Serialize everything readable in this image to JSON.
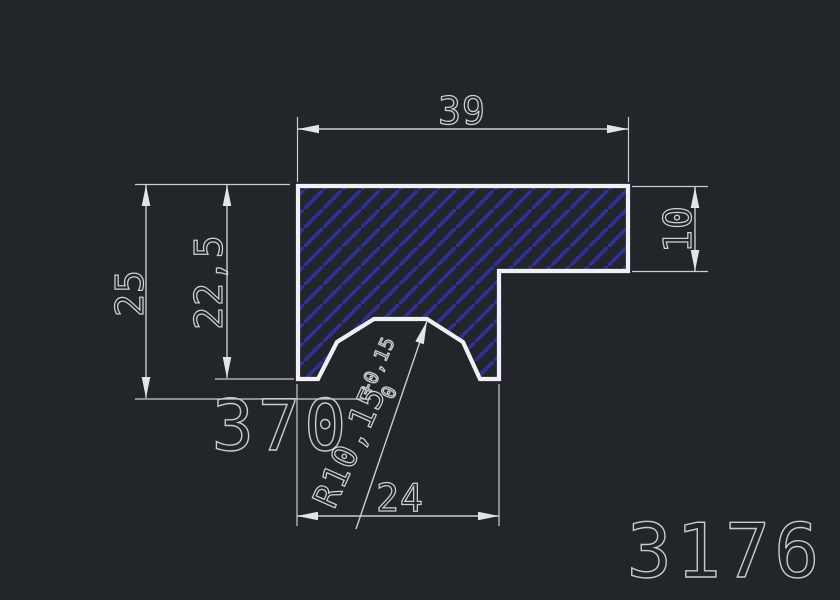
{
  "drawing": {
    "dims": {
      "top_width": "39",
      "overall_height": "25",
      "profile_height": "22,5",
      "step_height": "10",
      "groove_width": "24",
      "radius": "R10,15",
      "radius_tol_upper": "+0,15",
      "radius_tol_lower": "0"
    },
    "labels": {
      "watermark": "370",
      "part_number": "3176"
    },
    "colors": {
      "background": "#22262b",
      "profile_outline": "#eff1f4",
      "hatch_blue": "#30309b",
      "dimension_gray": "#c9cdd2",
      "text_gray": "#ccd1d6"
    }
  }
}
